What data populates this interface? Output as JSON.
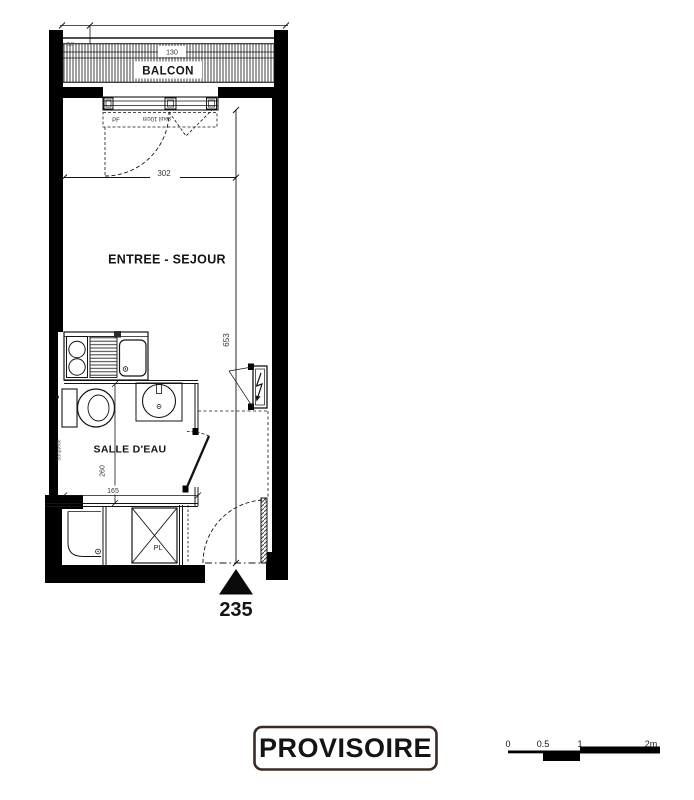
{
  "plan": {
    "balcony": {
      "label": "BALCON",
      "width_dim": "130",
      "corner_note": "GC"
    },
    "french_window": {
      "label": "PF",
      "sill_note": "seuil 10cm"
    },
    "living_room": {
      "label": "ENTREE - SEJOUR",
      "width_dim": "302",
      "depth_dim": "653"
    },
    "bathroom": {
      "label": "SALLE D'EAU",
      "depth_dim": "260",
      "width_dim": "165",
      "shower_note": "barquette"
    },
    "closet": {
      "label": "PL"
    },
    "entry": {
      "width_dim": "235"
    }
  },
  "stamp": {
    "label": "PROVISOIRE",
    "border_color": "#3b2b26",
    "text_color": "#251c1a"
  },
  "scale_bar": {
    "ticks": {
      "zero": "0",
      "half": "0.5",
      "one": "1",
      "two": "2m"
    }
  },
  "colors": {
    "ink": "#141414",
    "wall_fill": "#000000",
    "dim_text": "#2f3640"
  }
}
